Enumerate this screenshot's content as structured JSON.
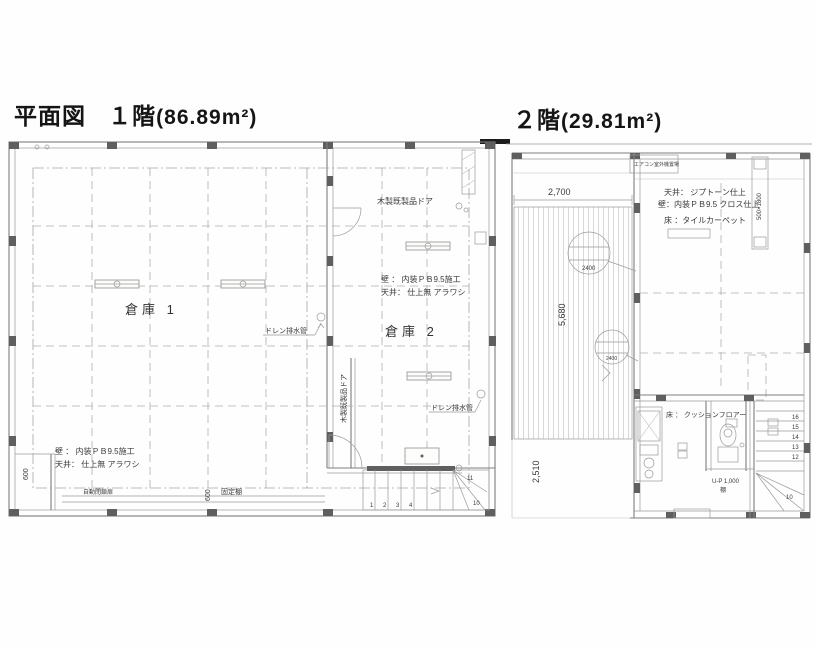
{
  "titles": {
    "plan_label": "平面図",
    "floor1_label": "１階",
    "floor1_area": "(86.89m²)",
    "floor2_label": "２階",
    "floor2_area": "(29.81m²)"
  },
  "floor1": {
    "room1_label": "倉庫 1",
    "room2_label": "倉庫 2",
    "spec_right_wall": "壁 ： 内装ＰＢ9.5施工",
    "spec_right_ceiling": "天井： 仕上無 アラワシ",
    "spec_left_wall": "壁 ： 内装ＰＢ9.5施工",
    "spec_left_ceiling": "天井： 仕上無 アラワシ",
    "drain_label_1": "ドレン排水管",
    "drain_label_2": "ドレン排水管",
    "wood_door_label_top": "木製既製品ドア",
    "wood_door_label_side": "木製既製品ドア",
    "auto_door_label": "自動閉鎖扉",
    "dim_600_left": "600",
    "dim_600_bottom": "600",
    "fixed_shelf_label": "固定棚",
    "stair_numbers": [
      "1",
      "2",
      "3",
      "4",
      "10",
      "11"
    ]
  },
  "floor2": {
    "spec_ceiling": "天井： ジプトーン仕上",
    "spec_wall": "壁：内装ＰＢ9.5 クロス仕上",
    "spec_floor": "床 ：タイルカーペット",
    "floor_note": "床 ： クッションフロアー",
    "aircon_label": "エアコン室外機置場",
    "dim_2700": "2,700",
    "dim_5680": "5,680",
    "dim_2510": "2,510",
    "window_size": "500×1800",
    "bubble1_value": "2400",
    "bubble2_value": "2400",
    "shelf_line1": "U-P 1,000",
    "shelf_line2": "棚",
    "stair_numbers": [
      "16",
      "15",
      "14",
      "13",
      "12",
      "10"
    ]
  }
}
